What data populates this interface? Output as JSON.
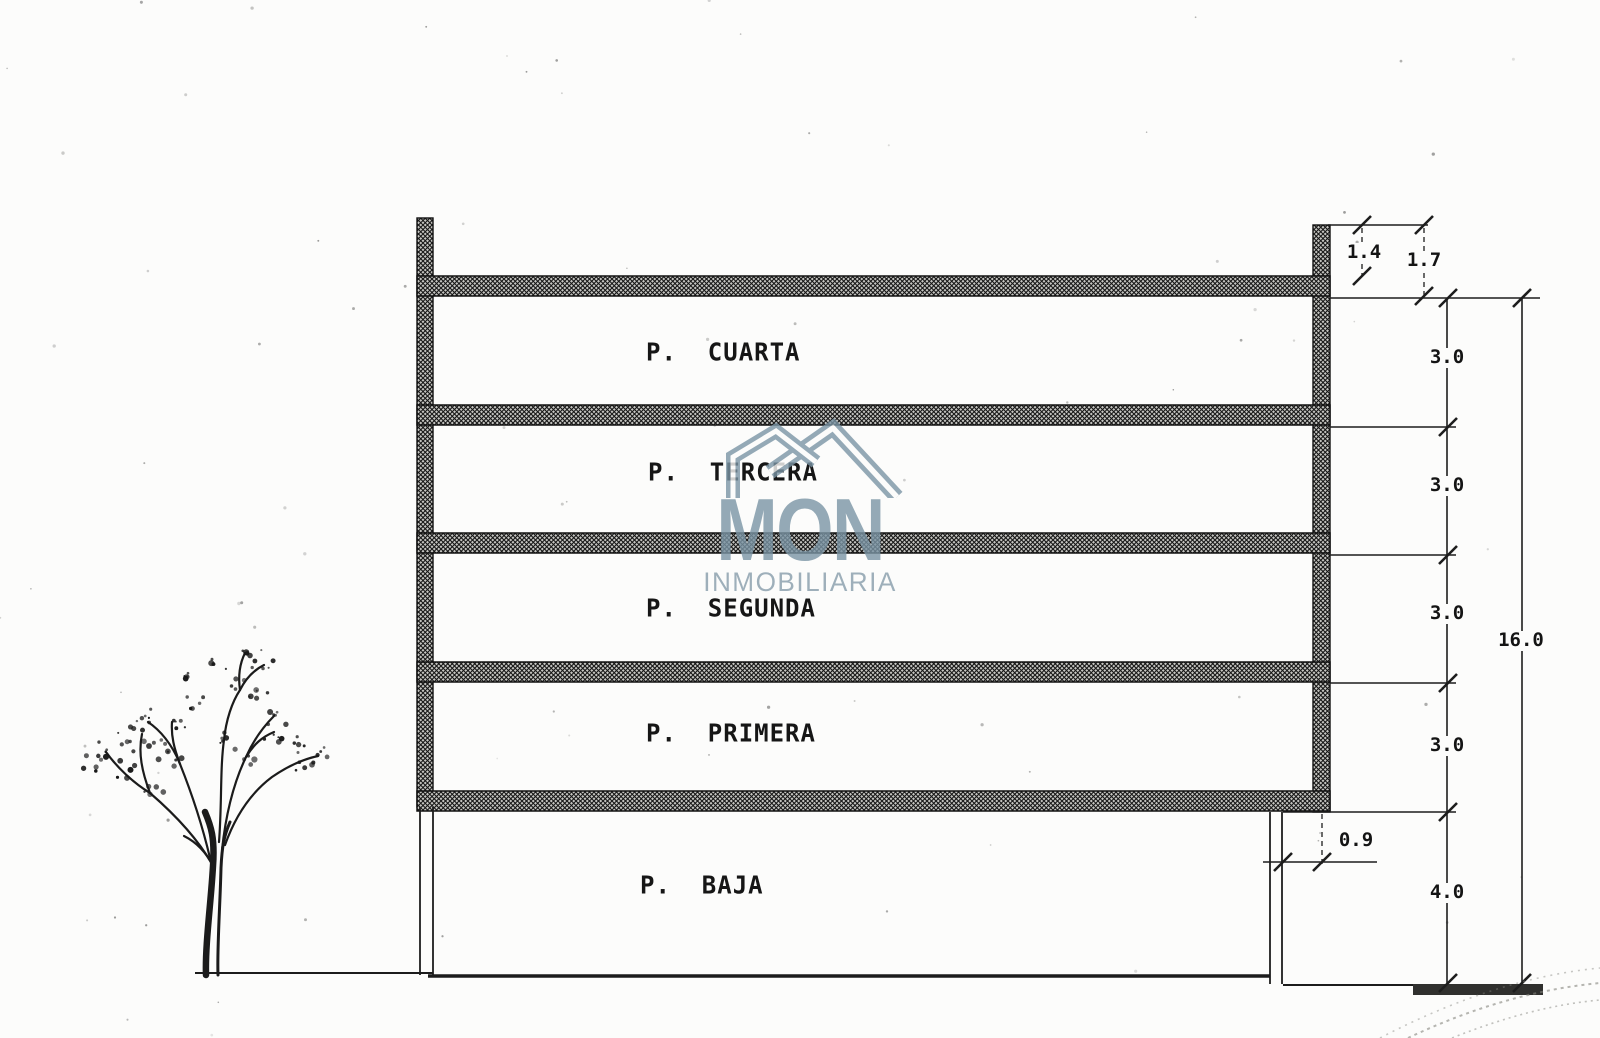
{
  "floors": [
    "P.  CUARTA",
    "P.  TERCERA",
    "P.  SEGUNDA",
    "P.  PRIMERA",
    "P.  BAJA"
  ],
  "dimensions": {
    "top": [
      "1.4",
      "1.7"
    ],
    "floor_heights": [
      "3.0",
      "3.0",
      "3.0",
      "3.0"
    ],
    "ground_floor": "4.0",
    "total": "16.0",
    "setback": "0.9"
  },
  "watermark": {
    "name": "MON",
    "subtitle": "INMOBILIARIA",
    "color": "#7b95a5"
  },
  "colors": {
    "ink": "#1d1d1d",
    "paper": "#fcfcfb",
    "hatch_fill": "#c6c6c2"
  }
}
